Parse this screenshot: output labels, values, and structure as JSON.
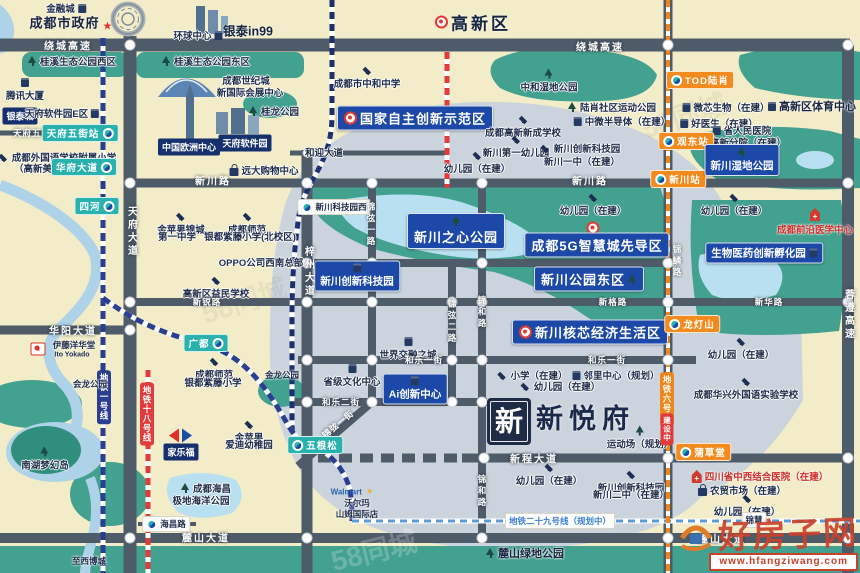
{
  "project": {
    "name": "新悦府",
    "emblem": "新"
  },
  "watermark": {
    "site": "好房子网",
    "url": "www.hfangziwang.com",
    "faint": "58同城"
  },
  "colors": {
    "background": "#f2ecc8",
    "district": "#cbd4dc",
    "park": "#42a18f",
    "water": "#aed3e8",
    "road": "#4e5b68",
    "badge_blue": "#1c49a8",
    "badge_teal": "#29b2ad",
    "badge_orange": "#f28a1d",
    "badge_navy": "#16306e",
    "metro1": "#2b3f90",
    "metro6": "#f08519",
    "metro18": "#e23b3b",
    "metro29": "#5b9bd5",
    "alert_red": "#cf2f2a"
  },
  "metro_lines": [
    {
      "name": "地铁一号线",
      "color": "#2b3f90"
    },
    {
      "name": "地铁六号线",
      "color": "#f08519",
      "status": "建设中"
    },
    {
      "name": "地铁十八号线",
      "color": "#e23b3b"
    },
    {
      "name": "地铁二十九号线（规划中）",
      "color": "#5b9bd5"
    }
  ],
  "labels": [
    {
      "t": "金融城",
      "x": 66,
      "y": 8,
      "c": "p",
      "i": "bld",
      "ip": "right"
    },
    {
      "t": "成都市政府",
      "x": 72,
      "y": 22,
      "c": "pb13",
      "i": "star",
      "ip": "right",
      "n": "city-government-label"
    },
    {
      "t": "环球中心",
      "x": 198,
      "y": 35,
      "c": "p",
      "i": "bld",
      "ip": "right"
    },
    {
      "t": "银泰in99",
      "x": 248,
      "y": 30,
      "c": "pb12"
    },
    {
      "t": "绕城高速",
      "x": 68,
      "y": 45,
      "c": "rd",
      "n": "road-label"
    },
    {
      "t": "绕城高速",
      "x": 600,
      "y": 46,
      "c": "rd",
      "n": "road-label"
    },
    {
      "t": "桂溪生态公园西区",
      "x": 72,
      "y": 61,
      "c": "p",
      "i": "tree",
      "ip": "left"
    },
    {
      "t": "桂溪生态公园东区",
      "x": 206,
      "y": 61,
      "c": "p",
      "i": "tree",
      "ip": "left"
    },
    {
      "t": "腾讯大厦",
      "x": 25,
      "y": 90,
      "c": "p",
      "i": "bld",
      "ip": "above"
    },
    {
      "t": "成都世纪城",
      "x": 246,
      "y": 80,
      "c": "p"
    },
    {
      "t": "新国际会展中心",
      "x": 250,
      "y": 92,
      "c": "p"
    },
    {
      "t": "银泰城",
      "x": 20,
      "y": 116,
      "c": "bn"
    },
    {
      "t": "天府软件园E区",
      "x": 62,
      "y": 113,
      "c": "p",
      "i": "bld",
      "ip": "right"
    },
    {
      "t": "桂龙公园",
      "x": 274,
      "y": 111,
      "c": "p",
      "i": "tree",
      "ip": "left"
    },
    {
      "t": "天府五街",
      "x": 32,
      "y": 133,
      "c": "rdsm",
      "n": "road-label"
    },
    {
      "t": "天府五街站",
      "x": 80,
      "y": 133,
      "c": "bt",
      "cp": "r",
      "n": "metro-station-badge"
    },
    {
      "t": "成都外国语学校附属小学",
      "x": 57,
      "y": 157,
      "c": "p",
      "i": "school",
      "ip": "left"
    },
    {
      "t": "（高新美年校区）",
      "x": 52,
      "y": 168,
      "c": "p"
    },
    {
      "t": "华府大道",
      "x": 84,
      "y": 167,
      "c": "bt",
      "cp": "r",
      "n": "metro-station-badge"
    },
    {
      "t": "中国欧洲中心",
      "x": 189,
      "y": 147,
      "c": "bn"
    },
    {
      "t": "天府软件园",
      "x": 245,
      "y": 143,
      "c": "bn"
    },
    {
      "t": "远大购物中心",
      "x": 264,
      "y": 170,
      "c": "p",
      "i": "shop",
      "ip": "left"
    },
    {
      "t": "新川路",
      "x": 213,
      "y": 180,
      "c": "rd",
      "n": "road-label"
    },
    {
      "t": "新川路",
      "x": 590,
      "y": 180,
      "c": "rd",
      "n": "road-label"
    },
    {
      "t": "新川站",
      "x": 678,
      "y": 179,
      "c": "bo",
      "cp": "l",
      "n": "metro-station-badge"
    },
    {
      "t": "高新区",
      "x": 473,
      "y": 22,
      "c": "pb17",
      "i": "target",
      "ip": "left",
      "n": "district-title"
    },
    {
      "t": "成都市中和中学",
      "x": 367,
      "y": 78,
      "c": "p",
      "i": "school",
      "ip": "above"
    },
    {
      "t": "中和湿地公园",
      "x": 549,
      "y": 81,
      "c": "p",
      "i": "tree",
      "ip": "above"
    },
    {
      "t": "国家自主创新示范区",
      "x": 415,
      "y": 118,
      "c": "bb13",
      "i": "target",
      "ip": "left",
      "n": "zone-badge"
    },
    {
      "t": "成都高新新成学校",
      "x": 523,
      "y": 127,
      "c": "p",
      "i": "school",
      "ip": "above"
    },
    {
      "t": "新川第一幼儿园",
      "x": 516,
      "y": 147,
      "c": "p",
      "i": "school",
      "ip": "above"
    },
    {
      "t": "新川创新科技园",
      "x": 580,
      "y": 148,
      "c": "p",
      "i": "school",
      "ip": "left"
    },
    {
      "t": "新川一中（在建）",
      "x": 582,
      "y": 161,
      "c": "p"
    },
    {
      "t": "幼儿园（在建）",
      "x": 477,
      "y": 163,
      "c": "p",
      "i": "school",
      "ip": "above"
    },
    {
      "t": "和迎大道",
      "x": 324,
      "y": 152,
      "c": "p"
    },
    {
      "t": "TOD陆肖",
      "x": 700,
      "y": 80,
      "c": "bo",
      "cp": "l",
      "n": "metro-station-badge"
    },
    {
      "t": "陆肖社区运动公园",
      "x": 612,
      "y": 107,
      "c": "p",
      "i": "tree",
      "ip": "left"
    },
    {
      "t": "微芯生物（在建）",
      "x": 726,
      "y": 107,
      "c": "p",
      "i": "bld",
      "ip": "left"
    },
    {
      "t": "好医生（在建）",
      "x": 719,
      "y": 123,
      "c": "p",
      "i": "bld",
      "ip": "left"
    },
    {
      "t": "高新区体育中心",
      "x": 812,
      "y": 106,
      "c": "pb11",
      "i": "bld",
      "ip": "left"
    },
    {
      "t": "中微半导体（在建）",
      "x": 622,
      "y": 121,
      "c": "p",
      "i": "bld",
      "ip": "left"
    },
    {
      "t": "省人民医院",
      "x": 742,
      "y": 130,
      "c": "p",
      "i": "bld",
      "ip": "left"
    },
    {
      "t": "高新分院（在建）",
      "x": 748,
      "y": 142,
      "c": "p"
    },
    {
      "t": "观东站",
      "x": 686,
      "y": 141,
      "c": "bo",
      "cp": "l",
      "n": "metro-station-badge"
    },
    {
      "t": "新川湿地公园",
      "x": 742,
      "y": 160,
      "c": "bb11",
      "i": "tree",
      "ip": "above",
      "n": "park-badge"
    },
    {
      "t": "成都前沿医学中心",
      "x": 815,
      "y": 222,
      "c": "red",
      "i": "hosp",
      "ip": "above"
    },
    {
      "t": "新川科技园西",
      "x": 334,
      "y": 207,
      "c": "wb",
      "cp": "l",
      "n": "metro-station-badge"
    },
    {
      "t": "新川之心公园",
      "x": 456,
      "y": 231,
      "c": "bb13",
      "i": "tree",
      "ip": "above",
      "n": "park-badge"
    },
    {
      "t": "",
      "x": 593,
      "y": 228,
      "c": "p",
      "i": "target"
    },
    {
      "t": "成都5G智慧城先导区",
      "x": 597,
      "y": 245,
      "c": "bb13",
      "n": "zone-badge"
    },
    {
      "t": "新川公园东区",
      "x": 589,
      "y": 279,
      "c": "bb13",
      "i": "tree",
      "ip": "right",
      "n": "park-badge"
    },
    {
      "t": "生物医药创新孵化园",
      "x": 764,
      "y": 253,
      "c": "bb11",
      "i": "bld",
      "ip": "right",
      "n": "zone-badge"
    },
    {
      "t": "新川创新科技园",
      "x": 357,
      "y": 276,
      "c": "bb11",
      "i": "bld",
      "ip": "above",
      "n": "zone-badge"
    },
    {
      "t": "幼儿园（在建）",
      "x": 593,
      "y": 205,
      "c": "p",
      "i": "school",
      "ip": "above"
    },
    {
      "t": "幼儿园（在建）",
      "x": 734,
      "y": 205,
      "c": "p",
      "i": "school",
      "ip": "above"
    },
    {
      "t": "新川核芯经济生活区",
      "x": 590,
      "y": 332,
      "c": "bb13",
      "i": "target",
      "ip": "left",
      "n": "zone-badge"
    },
    {
      "t": "龙灯山",
      "x": 692,
      "y": 324,
      "c": "bo",
      "cp": "l",
      "n": "metro-station-badge"
    },
    {
      "t": "世界交融之城",
      "x": 408,
      "y": 349,
      "c": "p",
      "i": "bld",
      "ip": "above"
    },
    {
      "t": "省级文化中心",
      "x": 352,
      "y": 376,
      "c": "p",
      "i": "bld",
      "ip": "above"
    },
    {
      "t": "Ai创新中心",
      "x": 415,
      "y": 389,
      "c": "bb11",
      "i": "bld",
      "ip": "above",
      "n": "zone-badge"
    },
    {
      "t": "和乐一街",
      "x": 424,
      "y": 360,
      "c": "rdsm",
      "n": "road-label"
    },
    {
      "t": "和乐一街",
      "x": 607,
      "y": 360,
      "c": "rdsm",
      "n": "road-label"
    },
    {
      "t": "和乐二街",
      "x": 341,
      "y": 402,
      "c": "rdsm",
      "n": "road-label"
    },
    {
      "t": "小学（在建）",
      "x": 532,
      "y": 375,
      "c": "p",
      "i": "school",
      "ip": "left"
    },
    {
      "t": "邻里中心（规划）",
      "x": 616,
      "y": 375,
      "c": "p",
      "i": "bld",
      "ip": "left"
    },
    {
      "t": "幼儿园（在建）",
      "x": 560,
      "y": 386,
      "c": "p",
      "i": "school",
      "ip": "left"
    },
    {
      "t": "幼儿园（在建）",
      "x": 741,
      "y": 349,
      "c": "p",
      "i": "school",
      "ip": "above"
    },
    {
      "t": "成都华兴外国语实验学校",
      "x": 746,
      "y": 389,
      "c": "p",
      "i": "school",
      "ip": "above"
    },
    {
      "t": "新程大道",
      "x": 534,
      "y": 458,
      "c": "rd",
      "n": "road-label"
    },
    {
      "t": "幼儿园（在建）",
      "x": 549,
      "y": 475,
      "c": "p",
      "i": "school",
      "ip": "above"
    },
    {
      "t": "运动场（规划）",
      "x": 640,
      "y": 438,
      "c": "p",
      "i": "tree",
      "ip": "above"
    },
    {
      "t": "新川创新科技园",
      "x": 631,
      "y": 482,
      "c": "p",
      "i": "school",
      "ip": "above"
    },
    {
      "t": "新川二中（在建）",
      "x": 631,
      "y": 494,
      "c": "p"
    },
    {
      "t": "四川省中西结合医院（在建）",
      "x": 760,
      "y": 476,
      "c": "red",
      "i": "hosp",
      "ip": "left"
    },
    {
      "t": "农贸市场（在建）",
      "x": 742,
      "y": 490,
      "c": "p",
      "i": "shop",
      "ip": "left"
    },
    {
      "t": "幼儿园（在建）",
      "x": 747,
      "y": 506,
      "c": "p",
      "i": "school",
      "ip": "above"
    },
    {
      "t": "蒲草堂",
      "x": 703,
      "y": 452,
      "c": "bo",
      "cp": "l",
      "n": "metro-station-badge"
    },
    {
      "t": "地铁六号线",
      "x": 667,
      "y": 399,
      "c": "ltvorange",
      "n": "metro-line-label"
    },
    {
      "t": "建设中",
      "x": 667,
      "y": 429,
      "c": "ltvredsm",
      "n": "metro-line-status"
    },
    {
      "t": "地铁一号线",
      "x": 104,
      "y": 397,
      "c": "ltvnavy",
      "n": "metro-line-label"
    },
    {
      "t": "地铁十八号线",
      "x": 147,
      "y": 414,
      "c": "ltvred",
      "n": "metro-line-label"
    },
    {
      "t": "地铁二十九号线（规划中）",
      "x": 560,
      "y": 521,
      "c": "wbblue",
      "n": "metro-line-label"
    },
    {
      "t": "锦慧",
      "x": 754,
      "y": 520,
      "c": "wb"
    },
    {
      "t": "麓山绿地公园",
      "x": 525,
      "y": 553,
      "c": "pb11",
      "i": "tree",
      "ip": "left"
    },
    {
      "t": "麓山大道",
      "x": 206,
      "y": 537,
      "c": "rd",
      "n": "road-label"
    },
    {
      "t": "麓山大道",
      "x": 722,
      "y": 538,
      "c": "rd",
      "n": "road-label"
    },
    {
      "t": "至西博城",
      "x": 89,
      "y": 561,
      "c": "psm"
    },
    {
      "t": "海昌路",
      "x": 166,
      "y": 524,
      "c": "wb",
      "cp": "l",
      "n": "metro-station-badge"
    },
    {
      "t": "成都海昌",
      "x": 206,
      "y": 488,
      "c": "p",
      "i": "tree",
      "ip": "left"
    },
    {
      "t": "极地海洋公园",
      "x": 201,
      "y": 500,
      "c": "p"
    },
    {
      "t": "金苹果",
      "x": 249,
      "y": 432,
      "c": "p",
      "i": "school",
      "ip": "above"
    },
    {
      "t": "爱迪幼稚园",
      "x": 249,
      "y": 444,
      "c": "p"
    },
    {
      "t": "",
      "x": 181,
      "y": 436,
      "c": "p",
      "i": "carrefour"
    },
    {
      "t": "家乐福",
      "x": 181,
      "y": 452,
      "c": "bn",
      "n": "carrefour-label"
    },
    {
      "t": "南湖梦幻岛",
      "x": 45,
      "y": 459,
      "c": "p",
      "i": "tree",
      "ip": "above"
    },
    {
      "t": "会龙公园",
      "x": 90,
      "y": 384,
      "c": "psm"
    },
    {
      "t": "金龙公园",
      "x": 282,
      "y": 375,
      "c": "psm"
    },
    {
      "t": "",
      "x": 38,
      "y": 349,
      "c": "p",
      "i": "ito"
    },
    {
      "t": "伊藤洋华堂",
      "x": 74,
      "y": 345,
      "c": "psm"
    },
    {
      "t": "Ito Yokado",
      "x": 72,
      "y": 355,
      "c": "pxs"
    },
    {
      "t": "华阳大道",
      "x": 73,
      "y": 330,
      "c": "rd",
      "n": "road-label"
    },
    {
      "t": "广都",
      "x": 206,
      "y": 343,
      "c": "bt",
      "cp": "r",
      "n": "metro-station-badge"
    },
    {
      "t": "成都师范",
      "x": 214,
      "y": 369,
      "c": "p",
      "i": "school",
      "ip": "above"
    },
    {
      "t": "银都紫藤小学",
      "x": 213,
      "y": 382,
      "c": "p"
    },
    {
      "t": "金苹果锦城",
      "x": 181,
      "y": 224,
      "c": "p",
      "i": "school",
      "ip": "above"
    },
    {
      "t": "第一中学",
      "x": 177,
      "y": 236,
      "c": "p"
    },
    {
      "t": "成都师范",
      "x": 247,
      "y": 224,
      "c": "p",
      "i": "school",
      "ip": "above"
    },
    {
      "t": "银都紫藤小学(北校区)",
      "x": 250,
      "y": 236,
      "c": "p"
    },
    {
      "t": "OPPO公司西南总部",
      "x": 261,
      "y": 262,
      "c": "p"
    },
    {
      "t": "高新区益民学校",
      "x": 216,
      "y": 288,
      "c": "p",
      "i": "school",
      "ip": "above"
    },
    {
      "t": "新锐路",
      "x": 207,
      "y": 302,
      "c": "rdsm",
      "n": "road-label"
    },
    {
      "t": "新格路",
      "x": 613,
      "y": 302,
      "c": "rdsm",
      "n": "road-label"
    },
    {
      "t": "新华路",
      "x": 769,
      "y": 302,
      "c": "rdsm",
      "n": "road-label"
    },
    {
      "t": "天府大道",
      "x": 131,
      "y": 232,
      "c": "rv",
      "n": "road-label"
    },
    {
      "t": "梓州大道",
      "x": 308,
      "y": 272,
      "c": "rv",
      "n": "road-label"
    },
    {
      "t": "锦弦一路",
      "x": 371,
      "y": 225,
      "c": "rvsm",
      "n": "road-label"
    },
    {
      "t": "锦弦二路",
      "x": 452,
      "y": 322,
      "c": "rvsm",
      "n": "road-label"
    },
    {
      "t": "锦和路",
      "x": 482,
      "y": 313,
      "c": "rvsm",
      "n": "road-label"
    },
    {
      "t": "锦和路",
      "x": 482,
      "y": 492,
      "c": "rvsm",
      "n": "road-label"
    },
    {
      "t": "锦鳞路",
      "x": 677,
      "y": 262,
      "c": "rvsm",
      "n": "road-label"
    },
    {
      "t": "蓉遵高速",
      "x": 848,
      "y": 315,
      "c": "rv",
      "n": "road-label"
    },
    {
      "t": "锦弦一街",
      "x": 338,
      "y": 424,
      "c": "rdsm",
      "r": -40,
      "n": "road-label"
    },
    {
      "t": "五根松",
      "x": 315,
      "y": 445,
      "c": "bt",
      "cp": "l",
      "n": "metro-station-badge"
    },
    {
      "t": "四河",
      "x": 97,
      "y": 206,
      "c": "bt",
      "cp": "r",
      "n": "metro-station-badge"
    },
    {
      "t": "Walmart",
      "x": 352,
      "y": 492,
      "c": "walmart",
      "n": "walmart-logo"
    },
    {
      "t": "沃尔玛",
      "x": 357,
      "y": 503,
      "c": "psm"
    },
    {
      "t": "山姆国际店",
      "x": 357,
      "y": 514,
      "c": "psm"
    }
  ]
}
